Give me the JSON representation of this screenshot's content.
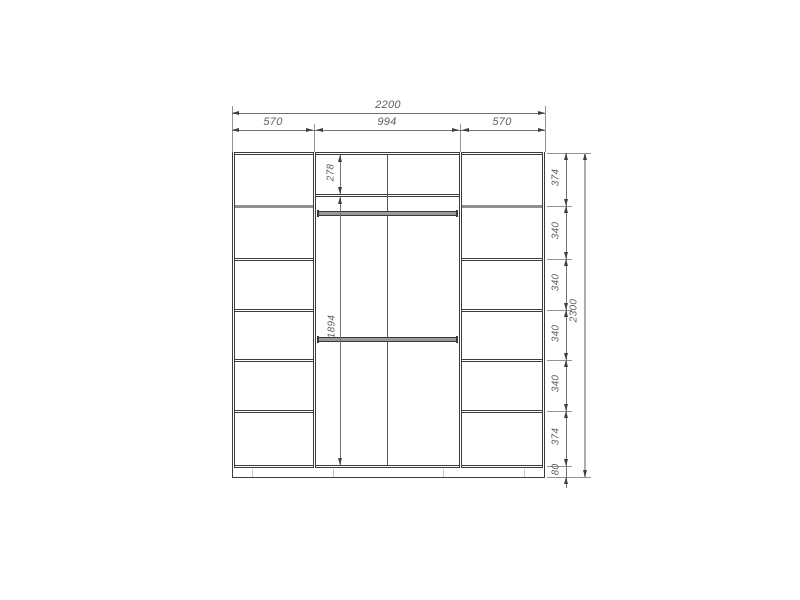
{
  "dims": {
    "overall_width": "2200",
    "sections": [
      "570",
      "994",
      "570"
    ],
    "overall_height": "2300",
    "right_chain": [
      "374",
      "340",
      "340",
      "340",
      "340",
      "374"
    ],
    "plinth_height": "80",
    "middle_top": "278",
    "middle_main": "1894"
  },
  "colors": {
    "background": "#ffffff",
    "body_line": "#3c3c3c",
    "dimension_line": "#707070",
    "label_text": "#5f5f5f"
  }
}
